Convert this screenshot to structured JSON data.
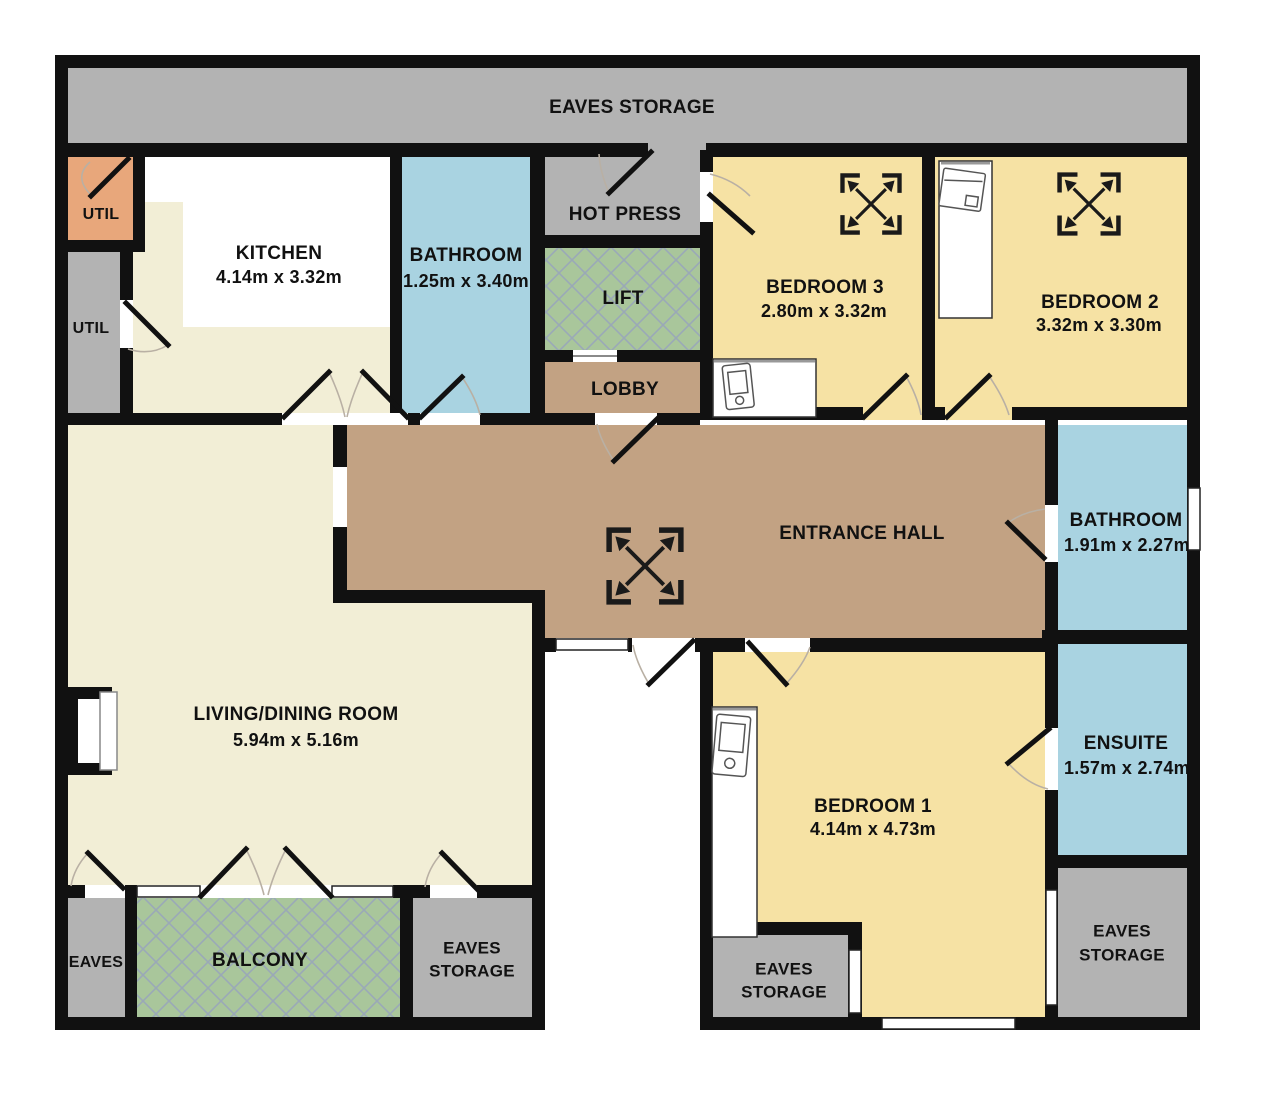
{
  "plan_title": "Attic apartment floor plan",
  "colors": {
    "wall": "#111111",
    "floor_cream": "#f2eed6",
    "floor_yellow": "#f6e2a4",
    "floor_blue": "#a9d3e1",
    "floor_green": "#a9c69b",
    "floor_brown": "#c2a283",
    "floor_gray": "#b3b3b3",
    "floor_orange": "#e8a77b",
    "hatch_line": "#9aa9b7"
  },
  "rooms": {
    "eaves_top": {
      "label": "EAVES STORAGE"
    },
    "util_orange": {
      "label": "UTIL"
    },
    "util_gray": {
      "label": "UTIL"
    },
    "kitchen": {
      "label": "KITCHEN",
      "dims": "4.14m x 3.32m"
    },
    "bathroom_top": {
      "label": "BATHROOM",
      "dims": "1.25m x 3.40m"
    },
    "hot_press": {
      "label": "HOT PRESS"
    },
    "lift": {
      "label": "LIFT"
    },
    "lobby": {
      "label": "LOBBY"
    },
    "bedroom3": {
      "label": "BEDROOM 3",
      "dims": "2.80m x 3.32m"
    },
    "bedroom2": {
      "label": "BEDROOM 2",
      "dims": "3.32m x 3.30m"
    },
    "entrance_hall": {
      "label": "ENTRANCE HALL"
    },
    "bathroom_main": {
      "label": "BATHROOM",
      "dims": "1.91m x 2.27m"
    },
    "living_dining": {
      "label": "LIVING/DINING ROOM",
      "dims": "5.94m x 5.16m"
    },
    "bedroom1": {
      "label": "BEDROOM 1",
      "dims": "4.14m x 4.73m"
    },
    "ensuite": {
      "label": "ENSUITE",
      "dims": "1.57m x 2.74m"
    },
    "eaves_left": {
      "label": "EAVES"
    },
    "balcony": {
      "label": "BALCONY"
    },
    "eaves_storage_left": {
      "line1": "EAVES",
      "line2": "STORAGE"
    },
    "eaves_storage_mid": {
      "line1": "EAVES",
      "line2": "STORAGE"
    },
    "eaves_storage_right": {
      "line1": "EAVES",
      "line2": "STORAGE"
    }
  }
}
